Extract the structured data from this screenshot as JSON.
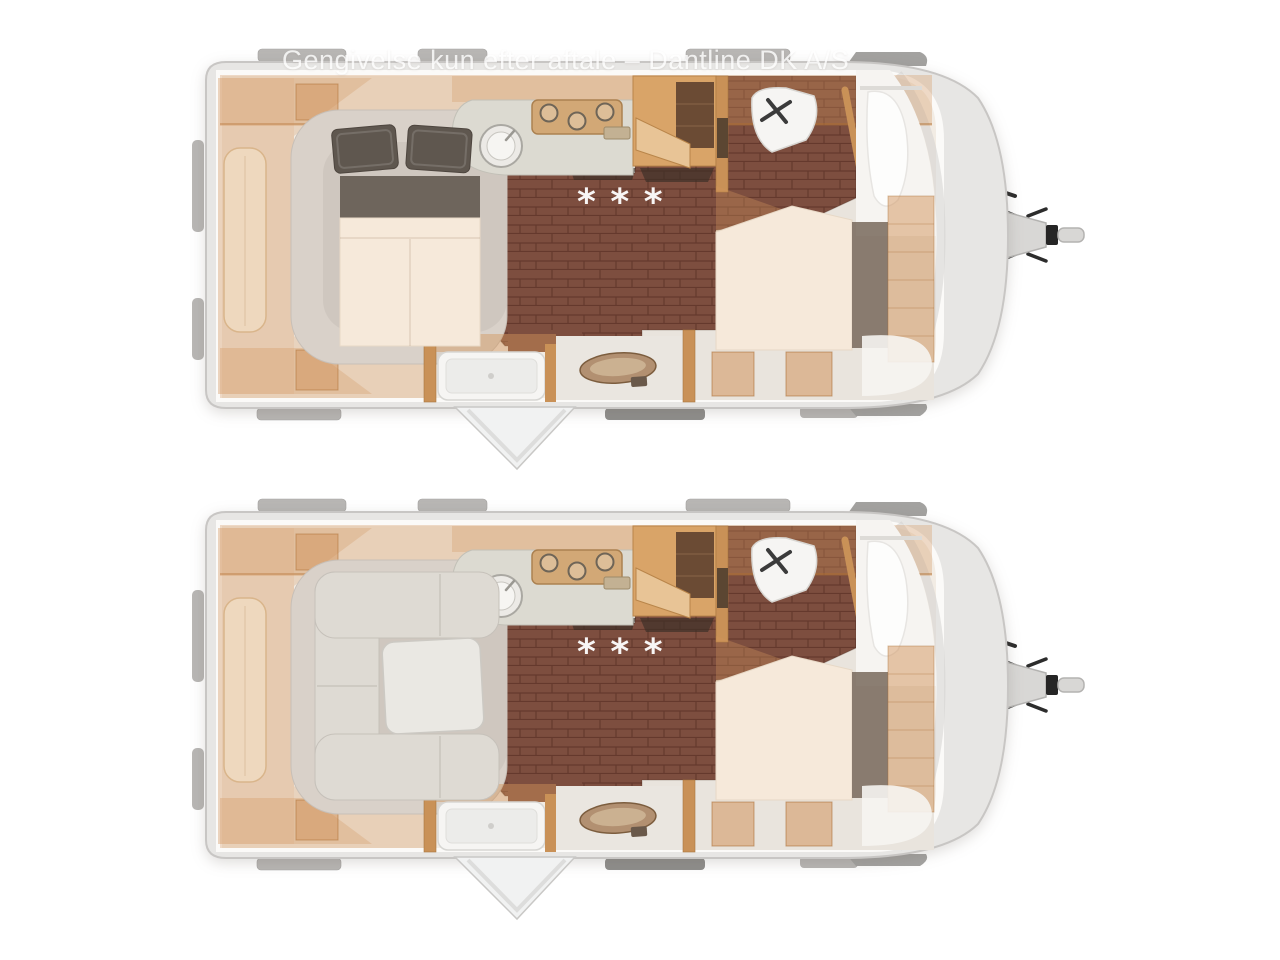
{
  "window": {
    "width": 1280,
    "height": 960,
    "background": "#ffffff"
  },
  "watermark": {
    "text": "Gengivelse kun efter aftale – Dantline DK A/S"
  },
  "plans": [
    {
      "id": "night-layout",
      "position": "top",
      "floor_marking": "* * *",
      "features": [
        "rear-french-bed-made-up",
        "kitchen-sink-and-hob",
        "wardrobe",
        "toilet-room-with-basin",
        "shower-with-open-door",
        "vanity-washbasin",
        "fixed-double-bed",
        "front-storage",
        "tow-hitch"
      ]
    },
    {
      "id": "day-layout",
      "position": "bottom",
      "floor_marking": "* * *",
      "features": [
        "rear-u-lounge-with-table",
        "kitchen-sink-and-hob",
        "wardrobe",
        "toilet-room-with-basin",
        "shower-with-open-door",
        "vanity-washbasin",
        "fixed-double-bed",
        "front-storage",
        "tow-hitch"
      ]
    }
  ],
  "colors": {
    "body": "#e7e6e4",
    "body_stroke": "#c8c6c4",
    "wall": "#fbfaf8",
    "interior": "#f2ece4",
    "deck": "#e9e4dd",
    "floor": "#7d4e3f",
    "floor_line": "#65392d",
    "cabinet": "#d2945c",
    "wood": "#c99157",
    "wood_dark": "#a9773f",
    "mattress": "#f6e9da",
    "pillow": "#5f574f",
    "headboard": "#6e655c",
    "sofa": "#dedad3",
    "counter": "#dcdad1",
    "fixture": "#f6f5f3",
    "hitch": "#d8d7d5",
    "ink": "#2c2c2c",
    "tab": "#b8b6b4",
    "watermark": "#ffffff"
  }
}
